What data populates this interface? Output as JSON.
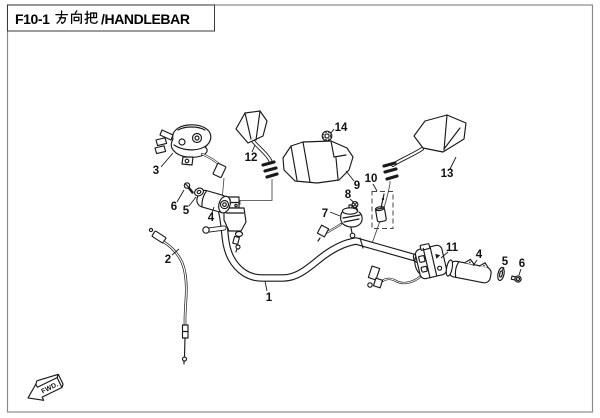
{
  "header": {
    "title": "F10-1 方向把/HANDLEBAR",
    "title_prefix": "F10-1",
    "title_cjk": "方向把",
    "title_suffix": "/HANDLEBAR"
  },
  "figure": {
    "code": "F10-1",
    "name_cn": "方向把",
    "name_en": "HANDLEBAR"
  },
  "footer": {
    "fwd_label": "FWD."
  },
  "diagram": {
    "callouts": {
      "c1": "1",
      "c2": "2",
      "c3": "3",
      "c4_left": "4",
      "c5_left": "5",
      "c6_left": "6",
      "c7": "7",
      "c8": "8",
      "c9": "9",
      "c10": "10",
      "c11": "11",
      "c4_right": "4",
      "c5_right": "5",
      "c6_right": "6",
      "c12": "12",
      "c13": "13",
      "c14": "14"
    },
    "colors": {
      "line": "#1a1a1a",
      "page_border": "#8a8a8a",
      "background": "#ffffff"
    }
  }
}
